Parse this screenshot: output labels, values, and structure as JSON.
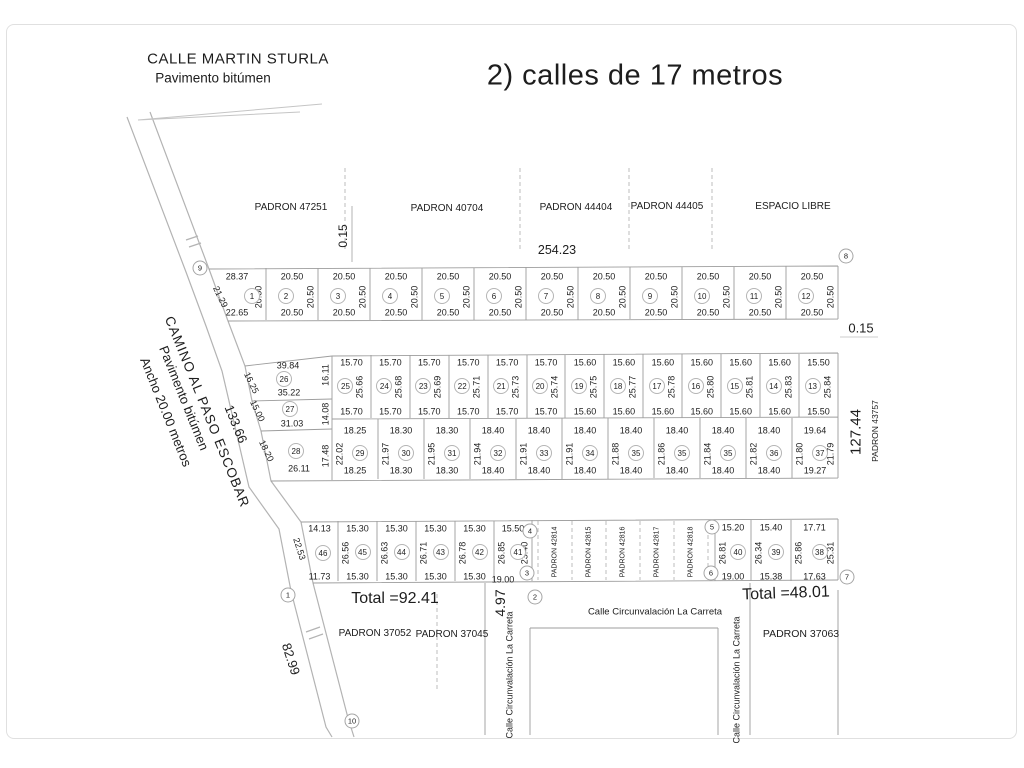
{
  "title": "2)  calles de 17 metros",
  "calle_martin_sturla": {
    "name": "CALLE MARTIN STURLA",
    "surface": "Pavimento bitúmen"
  },
  "camino_escobar": {
    "name": "CAMINO AL PASO ESCOBAR",
    "surface": "Pavimento bitúmen",
    "ancho": "Ancho 20.00 metros",
    "dist_upper": "133.66",
    "dist_lower": "82.99"
  },
  "padrones_top": [
    "PADRON 47251",
    "PADRON 40704",
    "PADRON 44404",
    "PADRON 44405",
    "ESPACIO LIBRE"
  ],
  "dims_top": {
    "block_width": "254.23",
    "gap": "0.15"
  },
  "right_side": {
    "gap": "0.15",
    "length": "127.44",
    "padron": "PADRON 43757"
  },
  "rows": {
    "row1": {
      "lots": [
        {
          "n": "1",
          "top": "28.37",
          "bottom": "22.65",
          "left": "21.29",
          "side": "20.50"
        },
        {
          "n": "2",
          "top": "20.50",
          "bottom": "20.50",
          "side": "20.50"
        },
        {
          "n": "3",
          "top": "20.50",
          "bottom": "20.50",
          "side": "20.50"
        },
        {
          "n": "4",
          "top": "20.50",
          "bottom": "20.50",
          "side": "20.50"
        },
        {
          "n": "5",
          "top": "20.50",
          "bottom": "20.50",
          "side": "20.50"
        },
        {
          "n": "6",
          "top": "20.50",
          "bottom": "20.50",
          "side": "20.50"
        },
        {
          "n": "7",
          "top": "20.50",
          "bottom": "20.50",
          "side": "20.50"
        },
        {
          "n": "8",
          "top": "20.50",
          "bottom": "20.50",
          "side": "20.50"
        },
        {
          "n": "9",
          "top": "20.50",
          "bottom": "20.50",
          "side": "20.50"
        },
        {
          "n": "10",
          "top": "20.50",
          "bottom": "20.50",
          "side": "20.50"
        },
        {
          "n": "11",
          "top": "20.50",
          "bottom": "20.50",
          "side": "20.50"
        },
        {
          "n": "12",
          "top": "20.50",
          "bottom": "20.50",
          "side": "20.50"
        }
      ]
    },
    "row2": {
      "lots": [
        {
          "n": "25",
          "top": "15.70",
          "bottom": "15.70",
          "side": "25.66"
        },
        {
          "n": "24",
          "top": "15.70",
          "bottom": "15.70",
          "side": "25.68"
        },
        {
          "n": "23",
          "top": "15.70",
          "bottom": "15.70",
          "side": "25.69"
        },
        {
          "n": "22",
          "top": "15.70",
          "bottom": "15.70",
          "side": "25.71"
        },
        {
          "n": "21",
          "top": "15.70",
          "bottom": "15.70",
          "side": "25.73"
        },
        {
          "n": "20",
          "top": "15.70",
          "bottom": "15.70",
          "side": "25.74"
        },
        {
          "n": "19",
          "top": "15.60",
          "bottom": "15.60",
          "side": "25.75"
        },
        {
          "n": "18",
          "top": "15.60",
          "bottom": "15.60",
          "side": "25.77"
        },
        {
          "n": "17",
          "top": "15.60",
          "bottom": "15.60",
          "side": "25.78"
        },
        {
          "n": "16",
          "top": "15.60",
          "bottom": "15.60",
          "side": "25.80"
        },
        {
          "n": "15",
          "top": "15.60",
          "bottom": "15.60",
          "side": "25.81"
        },
        {
          "n": "14",
          "top": "15.60",
          "bottom": "15.60",
          "side": "25.83"
        },
        {
          "n": "13",
          "top": "15.50",
          "bottom": "15.50",
          "side": "25.84"
        }
      ]
    },
    "row3": {
      "lots": [
        {
          "n": "29",
          "top": "18.25",
          "bottom": "18.25",
          "side": "22.02"
        },
        {
          "n": "30",
          "top": "18.30",
          "bottom": "18.30",
          "side": "21.97"
        },
        {
          "n": "31",
          "top": "18.30",
          "bottom": "18.30",
          "side": "21.95"
        },
        {
          "n": "32",
          "top": "18.40",
          "bottom": "18.40",
          "side": "21.94"
        },
        {
          "n": "33",
          "top": "18.40",
          "bottom": "18.40",
          "side": "21.91"
        },
        {
          "n": "34",
          "top": "18.40",
          "bottom": "18.40",
          "side": "21.91"
        },
        {
          "n": "35",
          "top": "18.40",
          "bottom": "18.40",
          "side": "21.88"
        },
        {
          "n": "35",
          "top": "18.40",
          "bottom": "18.40",
          "side": "21.86"
        },
        {
          "n": "35",
          "top": "18.40",
          "bottom": "18.40",
          "side": "21.84"
        },
        {
          "n": "36",
          "top": "18.40",
          "bottom": "18.40",
          "side": "21.82"
        },
        {
          "n": "37",
          "top": "19.64",
          "bottom": "19.27",
          "side": "21.80",
          "side_right": "21.79"
        }
      ]
    },
    "left_block": {
      "lots": [
        {
          "n": "26",
          "top": "39.84",
          "bottom": "35.22",
          "left": "16.25",
          "right": "16.11"
        },
        {
          "n": "27",
          "bottom": "31.03",
          "left": "15.00",
          "right": "14.08"
        },
        {
          "n": "28",
          "bottom": "26.11",
          "left": "18.20",
          "right": "17.48"
        }
      ]
    },
    "row4_left": {
      "lots": [
        {
          "n": "46",
          "top": "14.13",
          "bottom": "11.73",
          "left": "22.53"
        },
        {
          "n": "45",
          "top": "15.30",
          "bottom": "15.30",
          "side": "26.56"
        },
        {
          "n": "44",
          "top": "15.30",
          "bottom": "15.30",
          "side": "26.63"
        },
        {
          "n": "43",
          "top": "15.30",
          "bottom": "15.30",
          "side": "26.71"
        },
        {
          "n": "42",
          "top": "15.30",
          "bottom": "15.30",
          "side": "26.78"
        },
        {
          "n": "41",
          "top": "15.50",
          "bottom": "19.00",
          "side": "26.85",
          "side_right": "23.40"
        }
      ]
    },
    "row4_right": {
      "lots": [
        {
          "n": "40",
          "top": "15.20",
          "bottom": "19.00",
          "side": "26.81"
        },
        {
          "n": "39",
          "top": "15.40",
          "bottom": "15.38",
          "side": "26.34"
        },
        {
          "n": "38",
          "top": "17.71",
          "bottom": "17.63",
          "side": "25.86",
          "side_right": "25.31"
        }
      ]
    }
  },
  "padron_strips": [
    "PADRON 42814",
    "PADRON 42815",
    "PADRON 42816",
    "PADRON 42817",
    "PADRON 42818"
  ],
  "bottom": {
    "total_left": "Total =92.41",
    "gap": "4.97",
    "total_right": "Total =48.01",
    "padron_a": "PADRON 37052",
    "padron_b": "PADRON 37045",
    "padron_c": "PADRON 37063",
    "street": "Calle Circunvalación La Carreta"
  },
  "stations": [
    "1",
    "2",
    "3",
    "4",
    "5",
    "6",
    "7",
    "8",
    "9",
    "10"
  ],
  "colors": {
    "ink": "#1d1d1d",
    "line": "#9d9d9d",
    "road": "#b3b3b3"
  }
}
